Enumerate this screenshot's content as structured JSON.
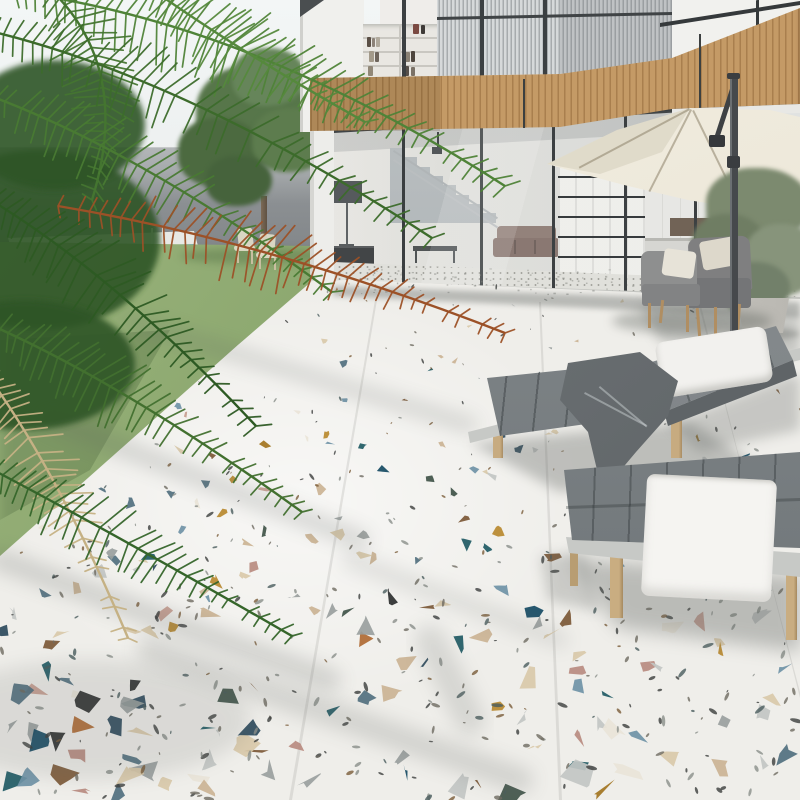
{
  "meta": {
    "title": "Modern villa terrace with colorful terrazzo patio",
    "kind": "architectural render photograph",
    "width": 800,
    "height": 800
  },
  "labels": {
    "sky": "sky",
    "boundary_wall": "grey boundary wall",
    "pool": "swimming pool",
    "pool_ladder": "pool ladder",
    "deck": "wooden pool deck",
    "lawn": "lawn",
    "garden_tree": "garden tree",
    "garden_chairs": "garden chairs",
    "house": "two-storey glass house",
    "wood_cladding": "wood slat balcony band",
    "bookshelf": "bookshelf on upper floor",
    "striped_panels": "corrugated facade panels",
    "glass_wall": "floor-to-ceiling glass wall",
    "staircase": "interior staircase",
    "floor_lamp": "interior floor lamp",
    "sofa": "interior sofa",
    "shelving": "black grid shelving",
    "kitchen": "kitchen cabinets",
    "umbrella": "cream cantilever patio umbrella",
    "olive_tree": "potted olive tree",
    "armchairs": "outdoor armchairs",
    "lounger_1": "sun lounger with pillow and blanket",
    "lounger_2": "sun lounger with towel",
    "pillow": "white pillow",
    "towel": "white towel",
    "blanket": "grey blanket",
    "terrazzo_floor": "white terrazzo patio floor with colored chips",
    "palm": "palm fronds"
  },
  "palette": {
    "sky": "#eef1f2",
    "wall_top": "#b3b6b8",
    "wall_bottom": "#83878a",
    "pool_water": "#459ac0",
    "pool_coping": "#e8e9e5",
    "deck": "#c2a075",
    "grass_light": "#9ab37c",
    "grass_dark": "#71905a",
    "tree_green": "#57764a",
    "house_white": "#f0f0ed",
    "wood_light": "#c49a66",
    "wood_dark": "#a97f4e",
    "stripe_light": "#d6d9da",
    "stripe_dark": "#a7abad",
    "frame_dark": "#34383a",
    "canopy": "#ece7d8",
    "canopy_shade": "#d8d1bd",
    "pole": "#46494c",
    "olive_foliage": "#7c8a6f",
    "planter": "#d7d5cf",
    "armchair_fabric": "#85868a",
    "armchair_pillow": "#e7e3d8",
    "cushion_grey": "#7d8285",
    "lounger_frame": "#c7c9c6",
    "leg_wood": "#b08e62",
    "pillow_white": "#f2f1ee",
    "towel_white": "#f5f4f1",
    "blanket_grey": "#6e7376",
    "terrazzo_base": "#efeeea",
    "floor_shadow": "#5f6460"
  },
  "terrazzo": {
    "chip_count": 215,
    "fleck_count": 400,
    "chips": [
      {
        "c": "#d9c9a9",
        "w": 3.0
      },
      {
        "c": "#cbb394",
        "w": 2.0
      },
      {
        "c": "#e9e4d8",
        "w": 1.0
      },
      {
        "c": "#c2c6c3",
        "w": 2.0
      },
      {
        "c": "#9aa09e",
        "w": 2.0
      },
      {
        "c": "#6f93a6",
        "w": 1.5
      },
      {
        "c": "#51707f",
        "w": 1.0
      },
      {
        "c": "#2c4a5c",
        "w": 1.2
      },
      {
        "c": "#1f5a64",
        "w": 1.2
      },
      {
        "c": "#154a63",
        "w": 0.8
      },
      {
        "c": "#b8892f",
        "w": 1.0
      },
      {
        "c": "#a2741f",
        "w": 0.6
      },
      {
        "c": "#c79d90",
        "w": 1.0
      },
      {
        "c": "#b98b80",
        "w": 0.6
      },
      {
        "c": "#7c5836",
        "w": 0.8
      },
      {
        "c": "#b06a33",
        "w": 0.6
      },
      {
        "c": "#2d2f2f",
        "w": 0.8
      },
      {
        "c": "#3f5248",
        "w": 0.8
      }
    ],
    "flecks": [
      {
        "c": "#3b3d3c",
        "w": 3
      },
      {
        "c": "#6e6a60",
        "w": 2
      },
      {
        "c": "#8a8e8a",
        "w": 2
      },
      {
        "c": "#7a5c3a",
        "w": 1
      },
      {
        "c": "#4a5c5e",
        "w": 1
      }
    ]
  },
  "palm": {
    "colors": {
      "g1": "#4f8338",
      "g2": "#3c6b2b",
      "g3": "#497a33",
      "g4": "#2d5a23",
      "g5": "#42702f",
      "g6": "#35652a",
      "g7": "#447530",
      "g8": "#55893c",
      "rust": "#9c5127",
      "dried": "#c5b184",
      "mass": "#2e5526"
    }
  },
  "floor_shadow_alpha": 0.22
}
